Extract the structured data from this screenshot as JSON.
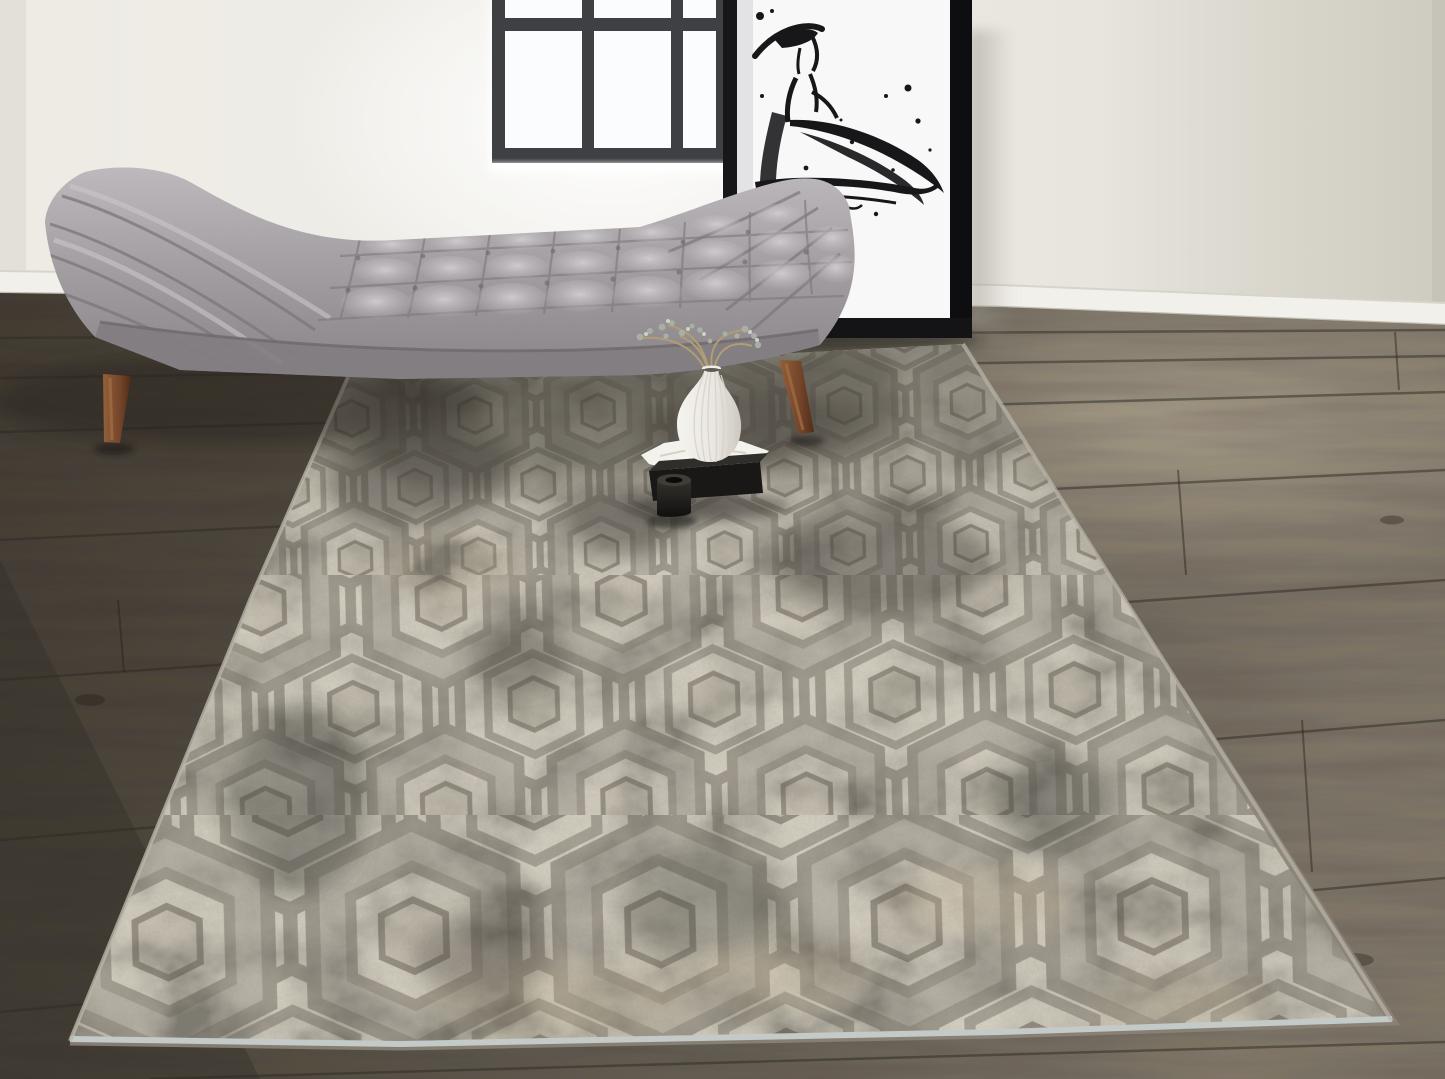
{
  "meta": {
    "kind": "interior lifestyle product photograph",
    "width_px": 1445,
    "height_px": 1079,
    "alt_text": "A bright room with a gray tufted upholstered bench, a black-framed ink fashion sketch leaning on the wall below a black-grid window, and a distressed ivory-and-gray hexagon-pattern area rug on dark wood flooring, styled with a white ribbed vase of dried sprigs on a black tray."
  },
  "scene": {
    "room": {
      "wall": {
        "description": "off-white painted wall with soft shadow on the right",
        "color": "#eceae3",
        "shadow_color": "#d3d0c6"
      },
      "baseboard": {
        "description": "white baseboard along wall-floor junction",
        "color": "#f1efe9"
      },
      "floor": {
        "description": "dark gray-brown wide-plank wood floor, brighter pool of light at right",
        "color_dark": "#49423a",
        "color_light": "#8d8374",
        "seam_color": "#2e2a24"
      }
    },
    "window": {
      "description": "black steel-grid window, partially cropped at top, glowing white panes",
      "frame_color": "#3e4043",
      "pane_color": "#fdfeff",
      "grid": {
        "columns": 3,
        "visible_rows": 2
      }
    },
    "artwork": {
      "description": "large black-framed ink sketch of a woman in a wide-brim hat and flowing dress, leaning against the wall",
      "frame_color": "#17171a",
      "paper_color": "#f8f8f9",
      "ink_color": "#17171a"
    },
    "bench": {
      "description": "mid-century biscuit-tufted bench/daybed with angled channel-tufted arms at both ends",
      "fabric_color": "#9b969a",
      "fabric_highlight": "#c7c3c6",
      "fabric_shadow": "#716c70",
      "leg_material": "walnut wood",
      "leg_color": "#7b4a2c"
    },
    "rug": {
      "description": "distressed ivory, beige and gray area rug with concentric hexagon (Hicks-style) pattern, laid diagonally",
      "base_color": "#d8d3c5",
      "pattern_line_color": "#a49e92",
      "ring_fill_color": "#bdb8ac",
      "distress_color": "#4e4b44",
      "accent_beige": "#c9b998",
      "binding_color": "#c4cac8"
    },
    "still_life": {
      "vase": {
        "description": "white ribbed teardrop vase with dried sprigs",
        "color": "#f0ede7",
        "sprig_color": "#a9b0a1",
        "stem_color": "#b29c72"
      },
      "tray": {
        "description": "black rectangular tray/box with white folded cloth",
        "box_color": "#191817",
        "cloth_color": "#f4f2ec"
      },
      "jar": {
        "description": "small black cylindrical jar in front of the tray",
        "color": "#1d1b18"
      }
    }
  },
  "palette": {
    "wall": "#eceae3",
    "window_frame": "#3e4043",
    "art_frame": "#17171a",
    "bench_fabric": "#9b969a",
    "wood_leg": "#7b4a2c",
    "floor": "#5a5349",
    "rug_ivory": "#d8d3c5",
    "rug_gray": "#a49e92",
    "rug_charcoal": "#4e4b44"
  }
}
